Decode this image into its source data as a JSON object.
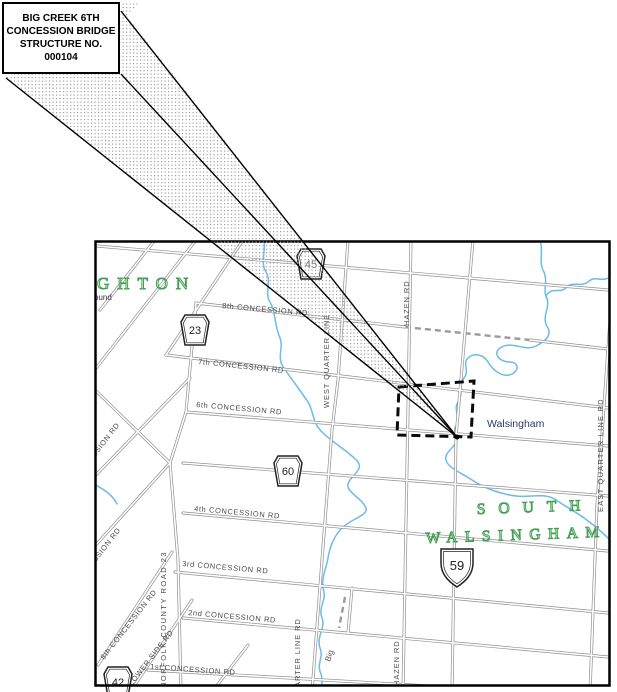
{
  "callout": {
    "line1": "BIG CREEK 6TH",
    "line2": "CONCESSION BRIDGE",
    "line3": "STRUCTURE NO.",
    "line4": "000104"
  },
  "map": {
    "townships": {
      "houghton_fragment": "GHTON",
      "south": "SOUTH",
      "walsingham": "WALSINGHAM"
    },
    "places": {
      "walsingham_village": "Walsingham",
      "ound_fragment": "ound",
      "big_creek": "Big"
    },
    "roads": {
      "concession8": "8th CONCESSION RD",
      "concession7": "7th CONCESSION RD",
      "concession6": "6th CONCESSION RD",
      "concession4": "4th CONCESSION RD",
      "concession3": "3rd CONCESSION RD",
      "concession2": "2nd CONCESSION RD",
      "concession1": "1st CONCESSION RD",
      "hazen_top": "HAZEN RD",
      "hazen_bottom": "HAZEN RD",
      "west_quarter": "WEST QUARTER LINE",
      "east_quarter": "EAST QUARTER LINE RD",
      "norfolk23": "NORFOLK COUNTY ROAD 23",
      "concession8_diag": "8th CONCESSION RD",
      "lower_side": "LOWER SIDE RD",
      "concession7_frag": "7th CONCESSION RD",
      "concession5_frag": "5th CONCESSION RD",
      "quarter_line_frag": "QUARTER LINE RD"
    },
    "shields": {
      "s45": "45",
      "s23": "23",
      "s60": "60",
      "s42": "42",
      "s59": "59"
    },
    "colors": {
      "water": "#6cbbe8",
      "township_green": "#3f9e4f",
      "road_casing": "#8f8f8f",
      "label_gray": "#4a4a4a",
      "place_navy": "#2a3a70"
    }
  }
}
